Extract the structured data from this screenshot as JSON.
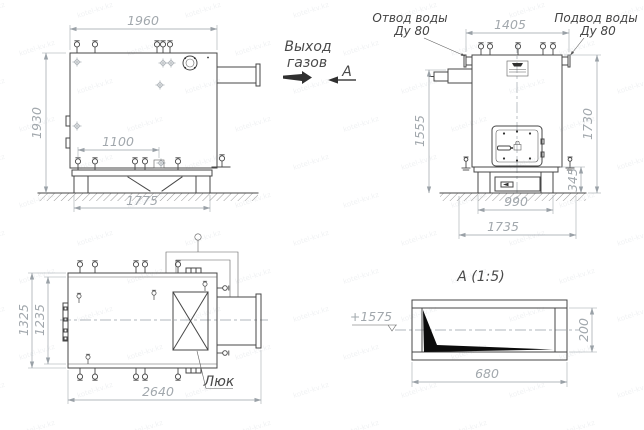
{
  "watermark": {
    "text": "kotel-kv.kz"
  },
  "annotations": {
    "gas_outlet": {
      "line1": "Выход",
      "line2": "газов"
    },
    "section_arrow_label": "А",
    "water_outlet": {
      "line1": "Отвод воды",
      "line2": "Ду 80"
    },
    "water_supply": {
      "line1": "Подвод воды",
      "line2": "Ду 80"
    },
    "hatch_label": "Люк",
    "section_title": "А (1:5)",
    "elevation_mark": "+1575"
  },
  "side_view": {
    "dims": {
      "top_width": "1960",
      "height": "1930",
      "bottom_inner": "1100",
      "base_width": "1775"
    }
  },
  "front_view": {
    "dims": {
      "top_width": "1405",
      "left_height": "1555",
      "right_height": "1730",
      "base_height": "345",
      "base_width": "990",
      "foundation_width": "1735"
    }
  },
  "plan_view": {
    "dims": {
      "outer_depth": "1325",
      "inner_depth": "1235",
      "overall_length": "2640"
    }
  },
  "section_view": {
    "dims": {
      "width": "680",
      "height": "200"
    }
  }
}
